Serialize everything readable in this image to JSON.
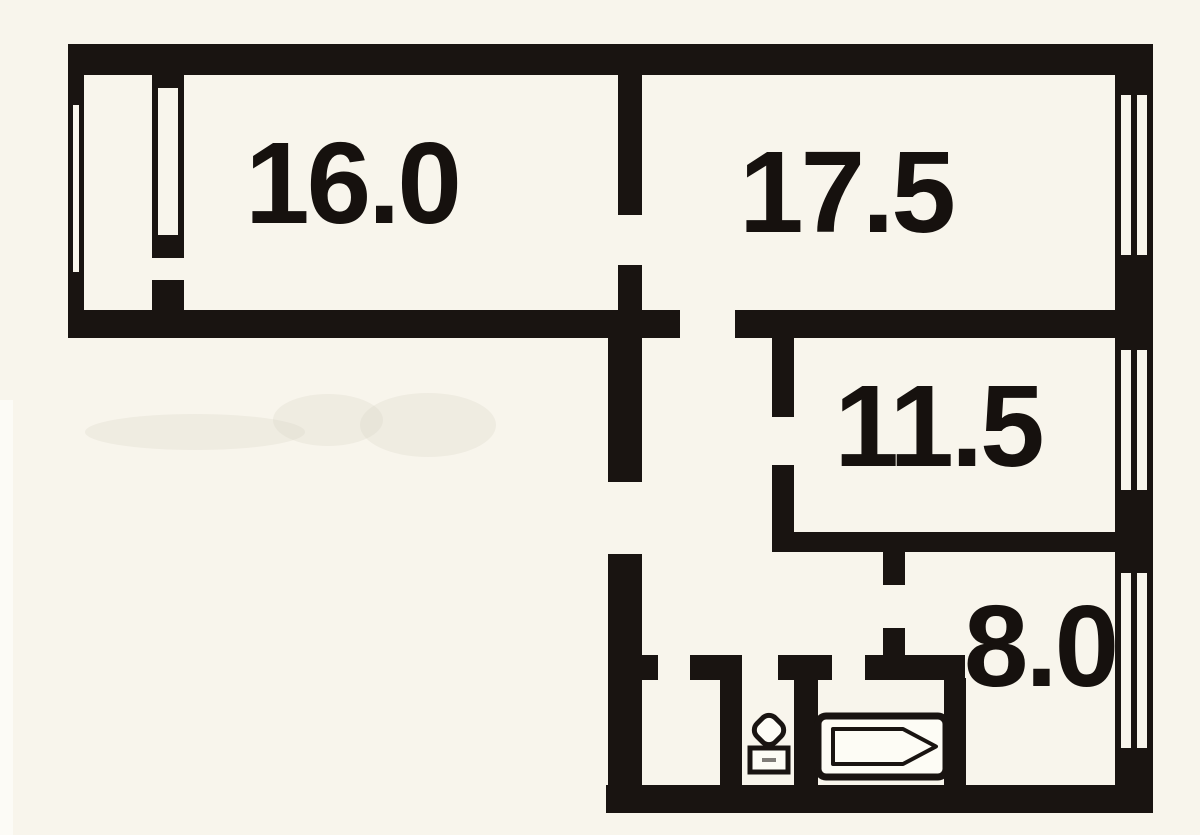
{
  "colors": {
    "background": "#f8f5ec",
    "wall": "#191411",
    "label": "#16110e"
  },
  "rooms": [
    {
      "id": "room-16-0",
      "label": "16.0"
    },
    {
      "id": "room-17-5",
      "label": "17.5"
    },
    {
      "id": "room-11-5",
      "label": "11.5"
    },
    {
      "id": "kitchen-8-0",
      "label": "8.0"
    }
  ],
  "fixtures": [
    {
      "name": "toilet"
    },
    {
      "name": "bathtub"
    }
  ]
}
